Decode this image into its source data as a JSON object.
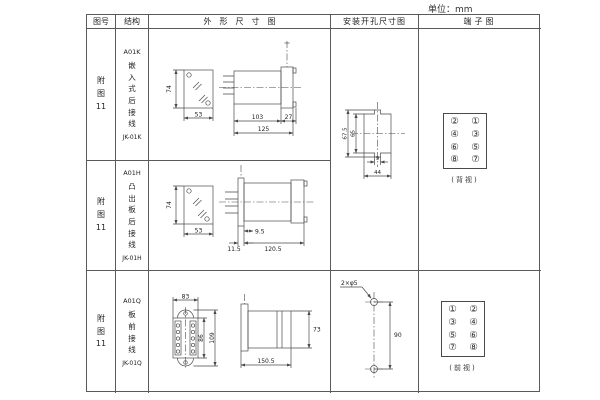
{
  "unit_label": "单位：mm",
  "header": {
    "col_figure": "图号",
    "col_structure": "结构",
    "col_outline": "外形尺寸图",
    "col_mounting": "安装开孔尺寸图",
    "col_terminal": "端子图"
  },
  "rows": [
    {
      "figure_lines": [
        "附",
        "图",
        "11"
      ],
      "model": "A01K",
      "desc": "嵌入式后接线",
      "code": "JK-01K"
    },
    {
      "figure_lines": [
        "附",
        "图",
        "11"
      ],
      "model": "A01H",
      "desc": "凸出板后接线",
      "code": "JK-01H"
    },
    {
      "figure_lines": [
        "附",
        "图",
        "11"
      ],
      "model": "A01Q",
      "desc": "板前接线",
      "code": "JK-01Q"
    }
  ],
  "outline_dims": {
    "r1": {
      "front_height": "74",
      "front_width": "53",
      "body_length": "103",
      "flange_depth": "27",
      "total_length": "125"
    },
    "r2": {
      "front_height": "74",
      "front_width": "53",
      "protrusion": "9.5",
      "flange_width": "11.5",
      "total_length": "120.5"
    },
    "r3": {
      "top_width": "83",
      "inner_height": "86",
      "outer_height": "109",
      "side_height": "73",
      "side_length": "150.5"
    }
  },
  "mounting": {
    "r12": {
      "outer_height": "67.5",
      "inner_height": "65",
      "notch_width": "9",
      "cutout_width": "44"
    },
    "r3": {
      "holes_label": "2×φ5",
      "hole_spacing": "90"
    }
  },
  "terminals": {
    "r12": {
      "left": [
        "②",
        "④",
        "⑥",
        "⑧"
      ],
      "right": [
        "①",
        "③",
        "⑤",
        "⑦"
      ],
      "caption": "(背视)"
    },
    "r3": {
      "left": [
        "①",
        "③",
        "⑤",
        "⑦"
      ],
      "right": [
        "②",
        "④",
        "⑥",
        "⑧"
      ],
      "caption": "(前视)"
    }
  }
}
